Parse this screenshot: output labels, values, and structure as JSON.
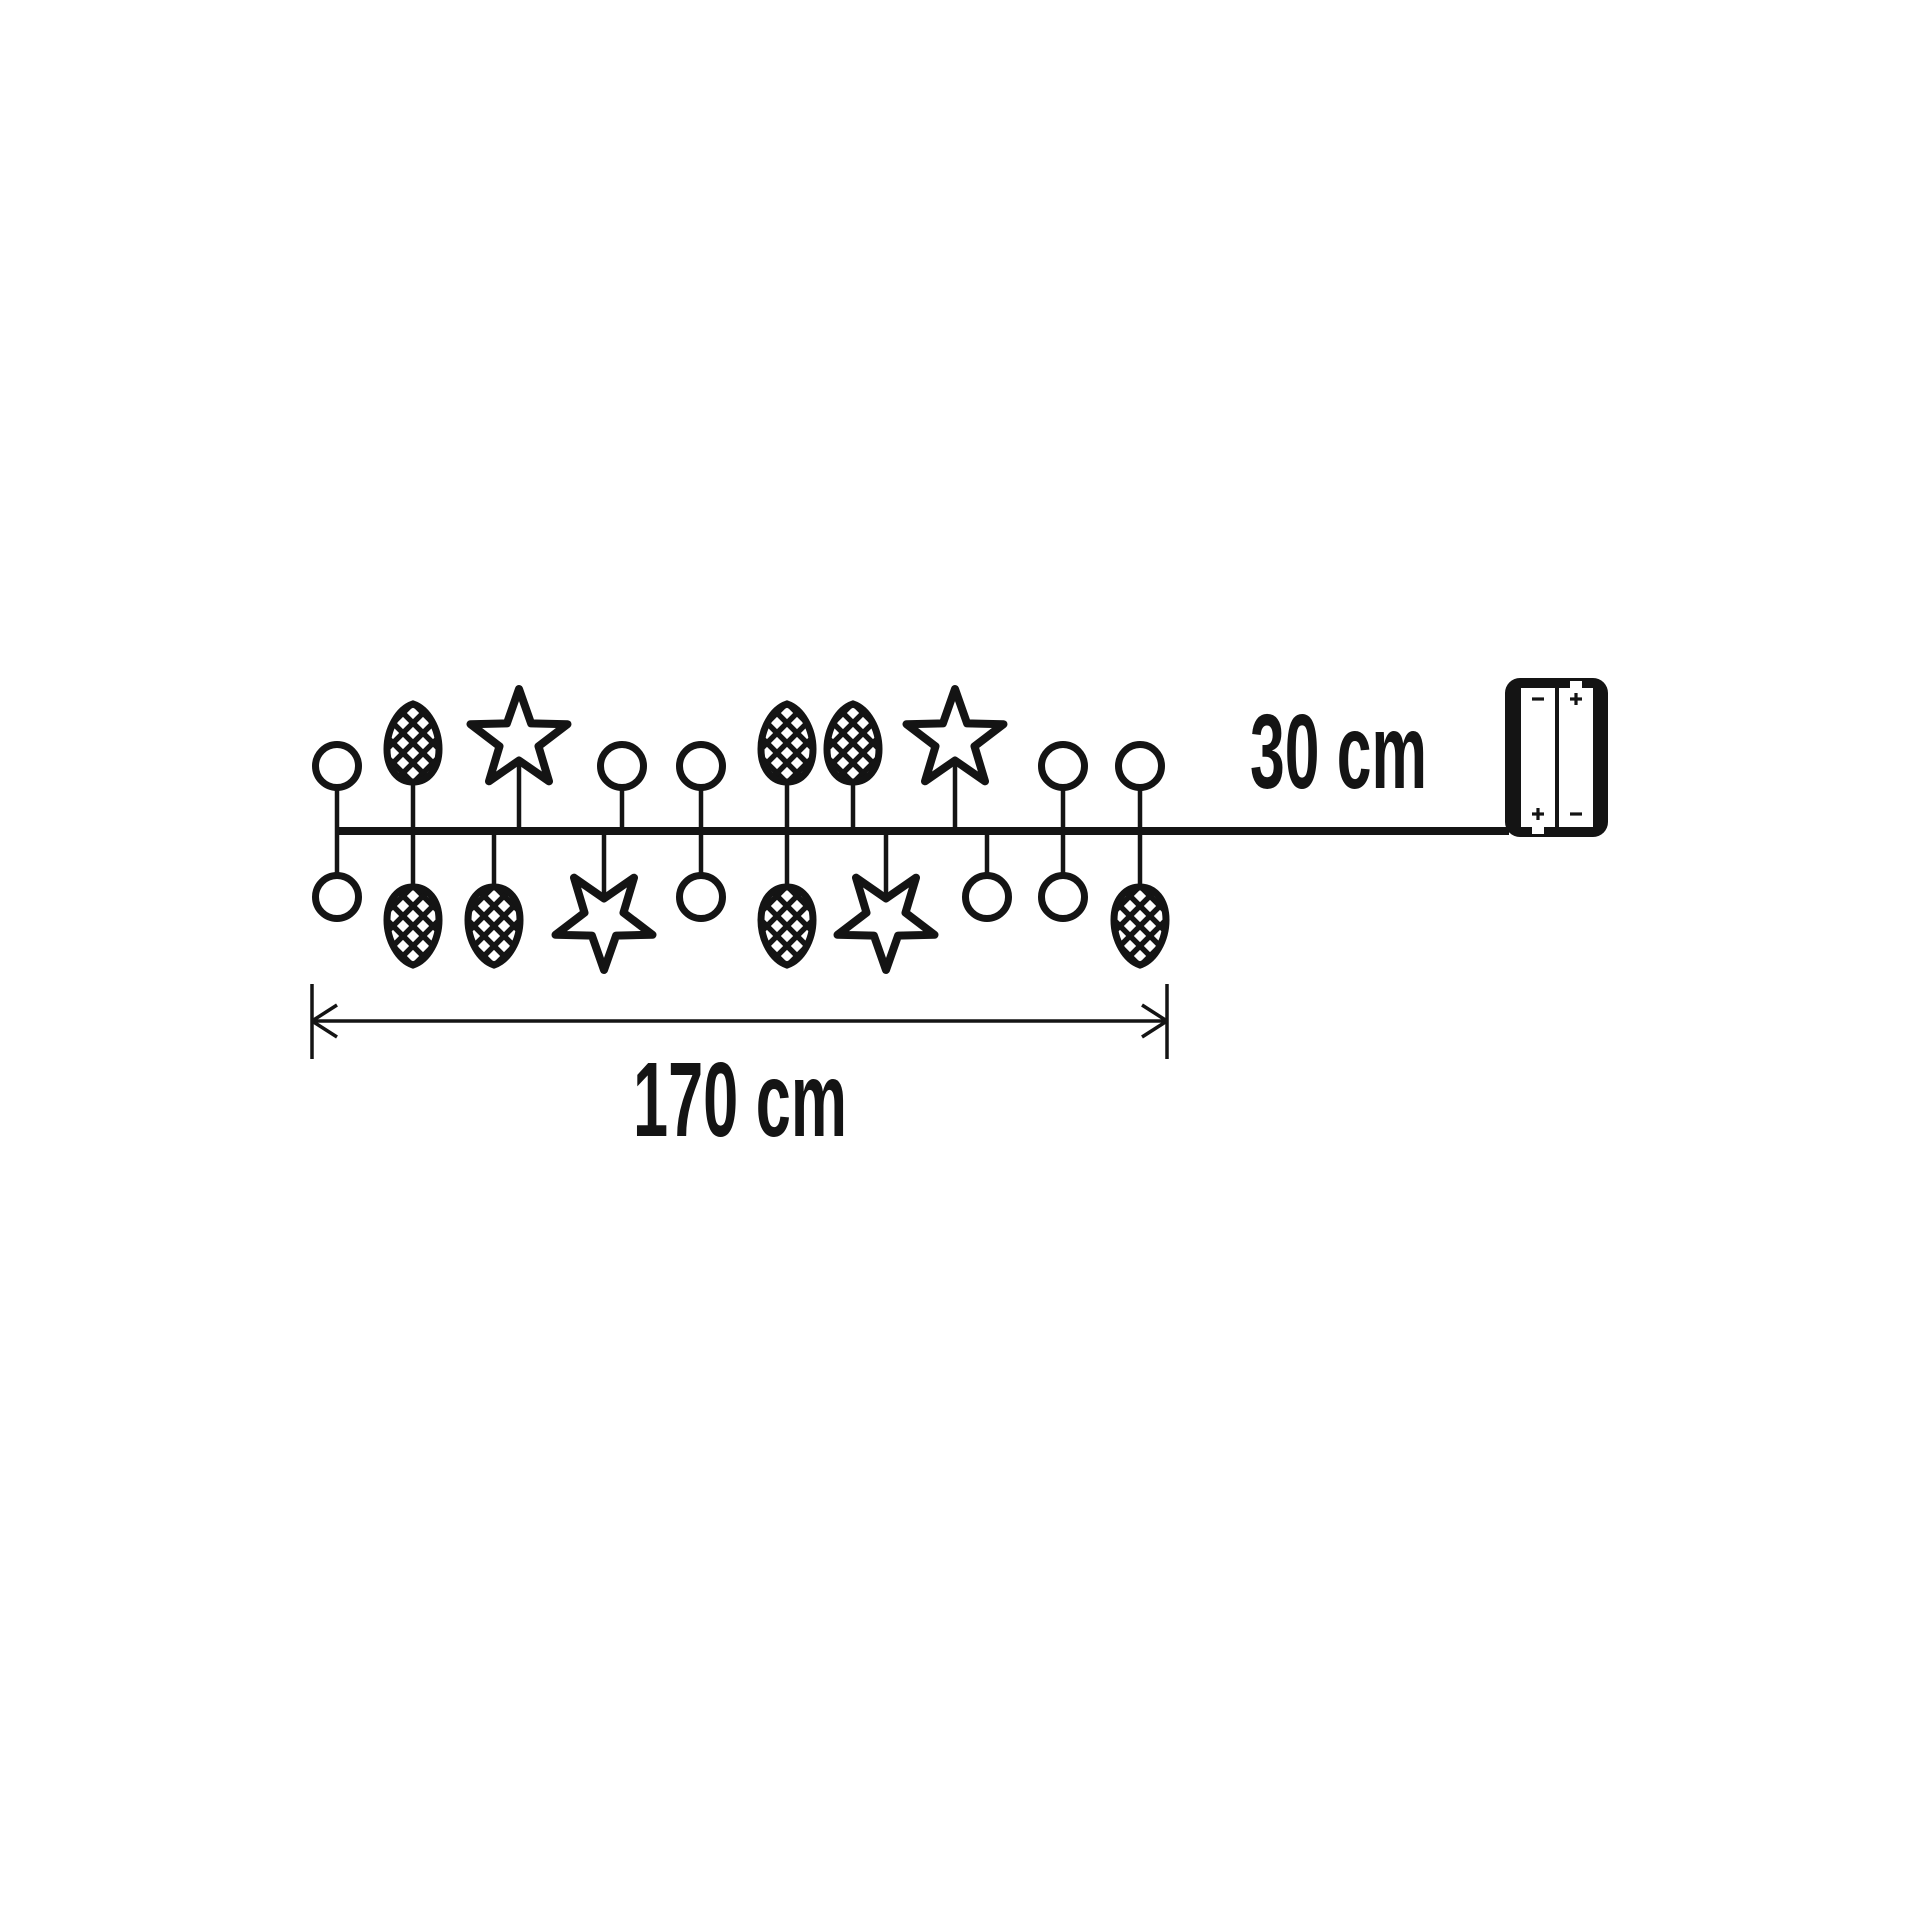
{
  "diagram": {
    "background": "#ffffff",
    "ink": "#141414",
    "lead_label": "30 cm",
    "dimension_label": "170 cm",
    "battery": {
      "left_top": "-",
      "left_bottom": "+",
      "right_top": "+",
      "right_bottom": "-"
    },
    "garland": {
      "ornament_types": [
        "circle",
        "bulb",
        "star"
      ],
      "drops": [
        {
          "x": 337,
          "top": "circle",
          "bottom": "circle"
        },
        {
          "x": 413,
          "top": "bulb",
          "bottom": "bulb"
        },
        {
          "x": 494,
          "bottom": "bulb"
        },
        {
          "x": 519,
          "top": "star"
        },
        {
          "x": 604,
          "bottom": "star"
        },
        {
          "x": 622,
          "top": "circle"
        },
        {
          "x": 701,
          "top": "circle",
          "bottom": "circle"
        },
        {
          "x": 787,
          "top": "bulb",
          "bottom": "bulb"
        },
        {
          "x": 853,
          "top": "bulb"
        },
        {
          "x": 886,
          "bottom": "star"
        },
        {
          "x": 955,
          "top": "star"
        },
        {
          "x": 987,
          "bottom": "circle"
        },
        {
          "x": 1063,
          "top": "circle",
          "bottom": "circle"
        },
        {
          "x": 1140,
          "top": "circle",
          "bottom": "bulb"
        }
      ]
    },
    "layout": {
      "wire": {
        "x1": 335,
        "x2": 1509,
        "y": 831,
        "width": 8,
        "stem_width": 4.5
      },
      "ornament_y": {
        "top": {
          "circle": 766,
          "bulb": 743,
          "star": 740
        },
        "bottom": {
          "circle": 897,
          "bulb": 926,
          "star": 919
        }
      },
      "dimension": {
        "x1": 312,
        "x2": 1167,
        "y": 1021,
        "tick_top": 984,
        "tick_bottom": 1059,
        "barb_dx": 25,
        "barb_dy": 16
      },
      "battery_box": {
        "x": 1505,
        "y": 678,
        "w": 103,
        "h": 159,
        "rx": 15,
        "slot_y": 688,
        "slot_h": 139,
        "slot_w": 34,
        "left_slot_x": 1521,
        "right_slot_x": 1559,
        "mark_top_y": 699,
        "mark_bottom_y": 814
      }
    }
  }
}
